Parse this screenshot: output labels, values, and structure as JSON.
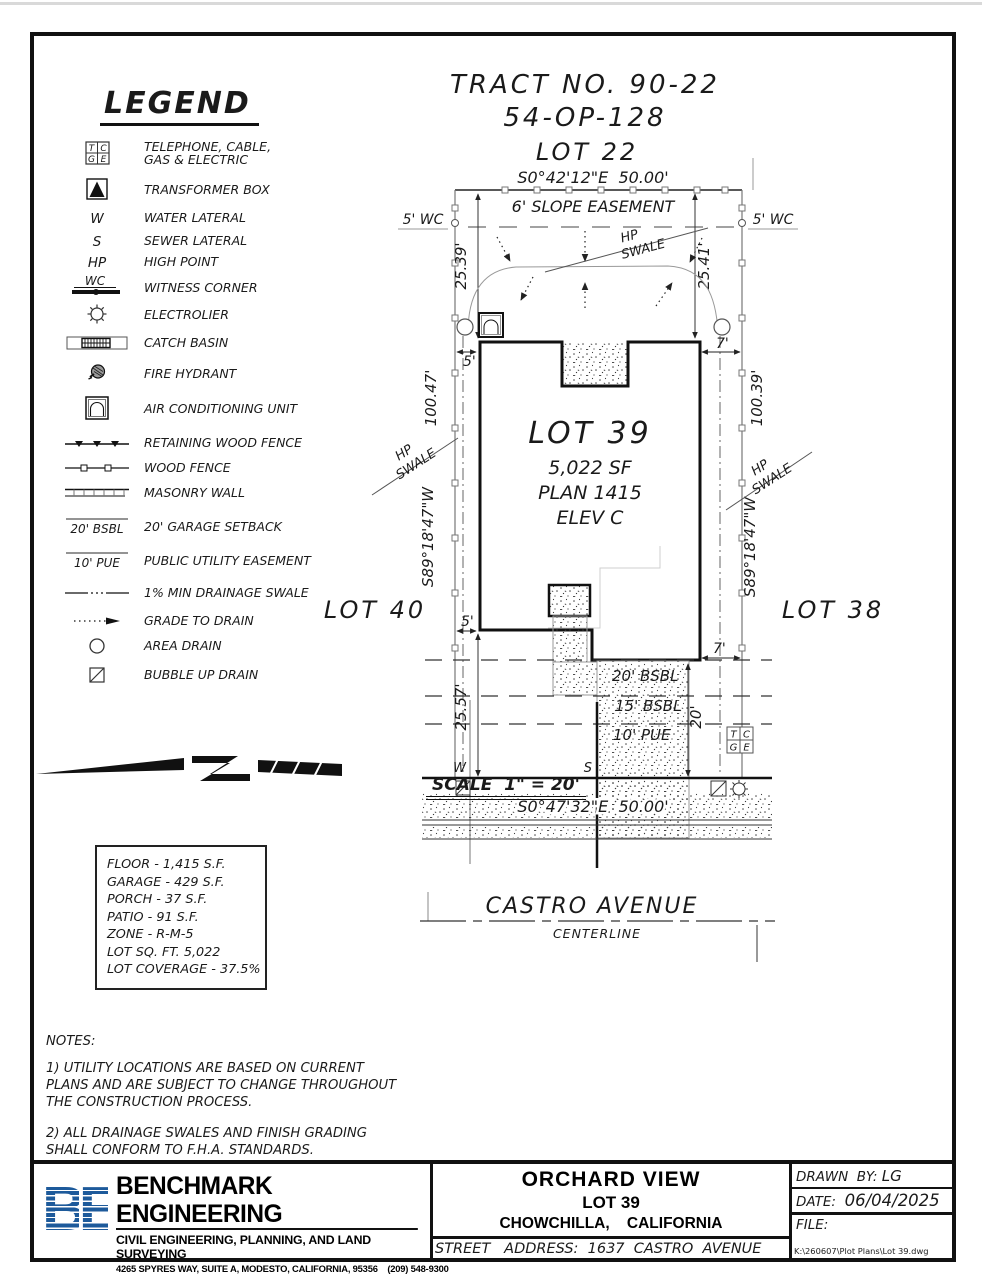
{
  "drawing": {
    "tract_no": "TRACT NO. 90-22",
    "tract_map": "54-OP-128",
    "lot_above": "LOT 22",
    "lot_left": "LOT 40",
    "lot_right": "LOT 38",
    "bearing_top": "S0°42'12\"E  50.00'",
    "bearing_bottom": "S0°47'32\"E  50.00'",
    "bearing_side": "S89°18'47\"W",
    "slope_easement": "6' SLOPE EASEMENT",
    "wc_note": "5' WC",
    "dim_left_front": "25.39'",
    "dim_right_front": "25.41'",
    "dim_left_depth": "100.47'",
    "dim_right_depth": "100.39'",
    "dim_left_rear": "25.57'",
    "dim_drive_depth": "20'",
    "setback_left": "5'",
    "setback_right": "7'",
    "hp": "HP",
    "swale": "SWALE",
    "lot_name": "LOT 39",
    "lot_sf": "5,022 SF",
    "lot_plan": "PLAN 1415",
    "lot_elev": "ELEV C",
    "bsbl20": "20' BSBL",
    "bsbl15": "15' BSBL",
    "pue10": "10' PUE",
    "water_mark": "W",
    "sewer_mark": "S",
    "street_name": "CASTRO AVENUE",
    "centerline": "CENTERLINE",
    "tcge": {
      "t": "T",
      "c": "C",
      "g": "G",
      "e": "E"
    }
  },
  "legend": {
    "title": "LEGEND",
    "items": [
      {
        "sym": "",
        "label": "TELEPHONE, CABLE, GAS & ELECTRIC"
      },
      {
        "sym": "",
        "label": "TRANSFORMER BOX"
      },
      {
        "sym": "W",
        "label": "WATER LATERAL"
      },
      {
        "sym": "S",
        "label": "SEWER LATERAL"
      },
      {
        "sym": "HP",
        "label": "HIGH POINT"
      },
      {
        "sym": "WC",
        "label": "WITNESS CORNER"
      },
      {
        "sym": "",
        "label": "ELECTROLIER"
      },
      {
        "sym": "",
        "label": "CATCH BASIN"
      },
      {
        "sym": "",
        "label": "FIRE HYDRANT"
      },
      {
        "sym": "",
        "label": "AIR CONDITIONING UNIT"
      },
      {
        "sym": "",
        "label": "RETAINING WOOD FENCE"
      },
      {
        "sym": "",
        "label": "WOOD FENCE"
      },
      {
        "sym": "",
        "label": "MASONRY WALL"
      },
      {
        "sym": "20' BSBL",
        "label": "20' GARAGE SETBACK"
      },
      {
        "sym": "10' PUE",
        "label": "PUBLIC UTILITY EASEMENT"
      },
      {
        "sym": "",
        "label": "1% MIN DRAINAGE SWALE"
      },
      {
        "sym": "",
        "label": "GRADE TO DRAIN"
      },
      {
        "sym": "",
        "label": "AREA DRAIN"
      },
      {
        "sym": "",
        "label": "BUBBLE UP DRAIN"
      }
    ]
  },
  "scale": {
    "label": "SCALE  1\" = 20'"
  },
  "stats": {
    "lines": [
      "FLOOR - 1,415 S.F.",
      "GARAGE - 429 S.F.",
      "PORCH - 37 S.F.",
      "PATIO - 91 S.F.",
      "ZONE - R-M-5",
      "LOT SQ. FT. 5,022",
      "LOT COVERAGE - 37.5%"
    ]
  },
  "notes": {
    "title": "NOTES:",
    "note1": "1) UTILITY LOCATIONS ARE BASED ON CURRENT PLANS AND ARE SUBJECT TO CHANGE THROUGHOUT THE CONSTRUCTION PROCESS.",
    "note2": "2) ALL DRAINAGE SWALES AND FINISH GRADING SHALL CONFORM TO F.H.A. STANDARDS."
  },
  "titleblock": {
    "logo_b": "B",
    "logo_e": "E",
    "company": "BENCHMARK ENGINEERING",
    "tagline": "CIVIL ENGINEERING, PLANNING, AND LAND SURVEYING",
    "address": "4265 SPYRES WAY, SUITE A, MODESTO, CALIFORNIA, 95356    (209) 548-9300",
    "project": "ORCHARD VIEW",
    "lot": "LOT 39",
    "city": "CHOWCHILLA,    CALIFORNIA",
    "street_address": "STREET   ADDRESS:  1637  CASTRO  AVENUE",
    "drawn_by_label": "DRAWN  BY:",
    "drawn_by": "LG",
    "date_label": "DATE:",
    "date": "06/04/2025",
    "file_label": "FILE:",
    "file_path": "K:\\260607\\Plot Plans\\Lot 39.dwg"
  },
  "colors": {
    "ink": "#111111",
    "gray": "#888888",
    "logo_blue": "#1d5a9b"
  }
}
